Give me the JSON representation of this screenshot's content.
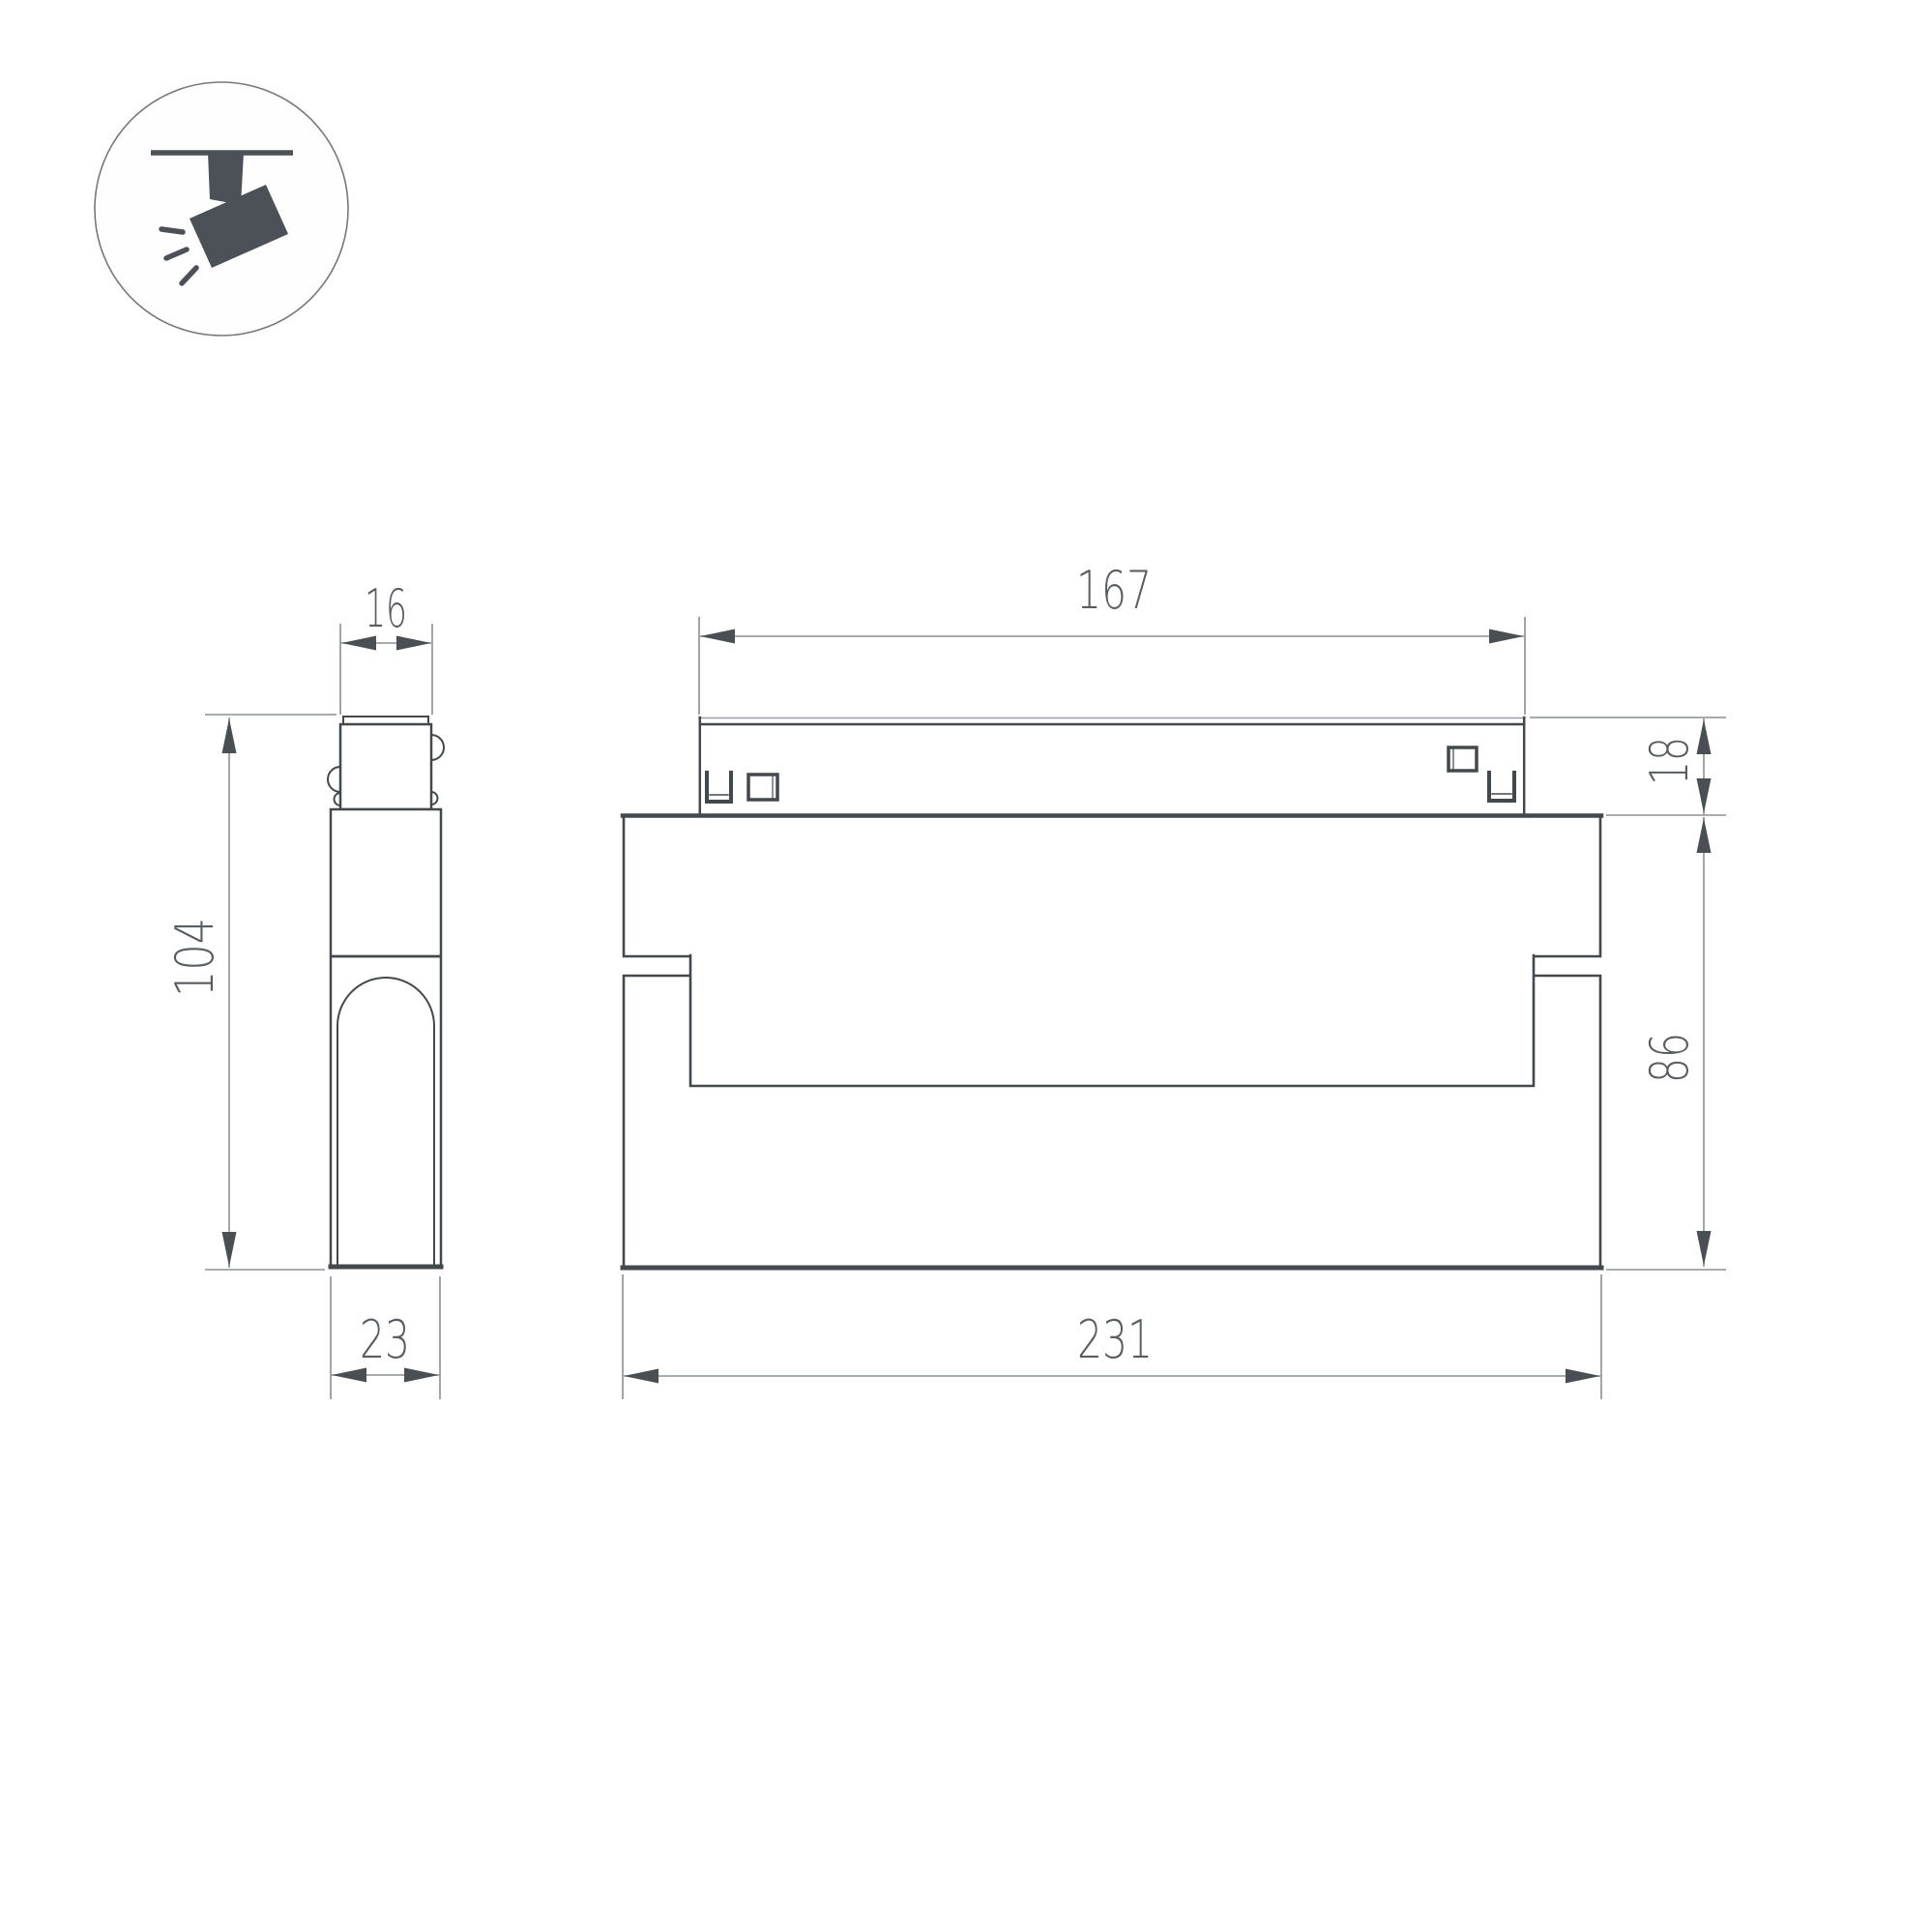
{
  "drawing": {
    "background": "#ffffff",
    "line_color_dark": "#43484d",
    "dim_line_color": "#8b8f93",
    "arrow_color": "#4a4f54",
    "text_color": "#585d62",
    "icon_color": "#4b5156"
  },
  "icon": {
    "name": "ceiling-track-spotlight-pictogram"
  },
  "dimensions": {
    "side_track_width": "16",
    "side_height": "104",
    "side_depth": "23",
    "front_track_length": "167",
    "front_track_height": "18",
    "front_body_height": "86",
    "front_total_length": "231"
  }
}
